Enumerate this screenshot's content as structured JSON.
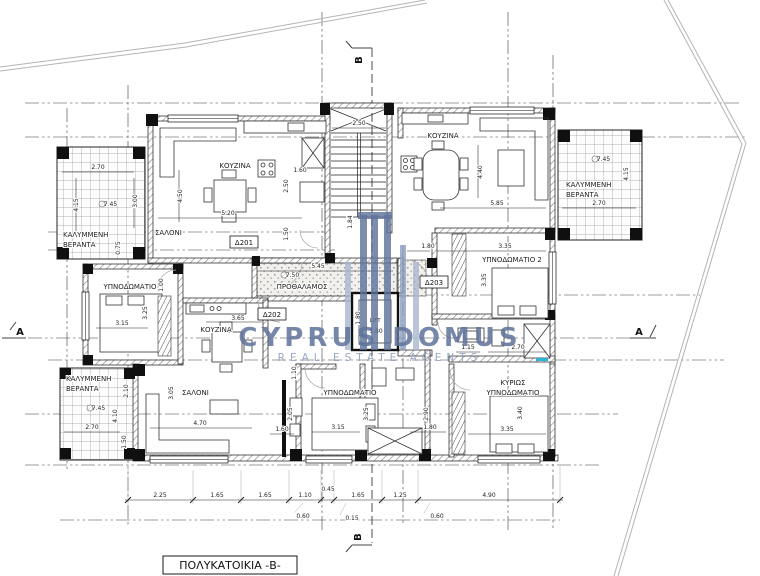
{
  "title": {
    "label": "ΠΟΛΥΚΑΤΟΙΚΙΑ -Β-"
  },
  "watermark": {
    "name": "CYPRUS DOMUS",
    "tagline": "REAL ESTATE AGENTS"
  },
  "colors": {
    "watermark_dark": "#5f739b",
    "watermark_light": "#a9b7cf",
    "accent_cyan": "#2ab5d8"
  },
  "sections": {
    "a": "A",
    "b": "B"
  },
  "units": {
    "d201": "Δ201",
    "d202": "Δ202",
    "d203": "Δ203"
  },
  "rooms": {
    "kitchen": "ΚΟΥΖΙΝΑ",
    "living": "ΣΑΛΟΝΙ",
    "bedroom": "ΥΠΝΟΔΩΜΑΤΙΟ",
    "bedroom2": "ΥΠΝΟΔΩΜΑΤΙΟ 2",
    "master_line1": "ΚΥΡΙΩΣ",
    "master_line2": "ΥΠΝΟΔΩΜΑΤΙΟ",
    "veranda_line1": "ΚΑΛΥΜΜΕΝΗ",
    "veranda_line2": "ΒΕΡΑΝΤΑ",
    "hall": "ΠΡΟΘΑΛΑΜΟΣ",
    "lift": "LIFT"
  },
  "levels": {
    "v745": "+7.45",
    "v750": "+7.50"
  },
  "dims": {
    "v015": "0.15",
    "v045": "0.45",
    "v060": "0.60",
    "v075": "0.75",
    "v100": "1.00",
    "v110": "1.10",
    "v115": "1.15",
    "v125": "1.25",
    "v150": "1.50",
    "v160": "1.60",
    "v165": "1.65",
    "v180": "1.80",
    "v184": "1.84",
    "v205": "2.05",
    "v210": "2.10",
    "v225": "2.25",
    "v250": "2.50",
    "v270": "2.70",
    "v290": "2.90",
    "v300": "3.00",
    "v305": "3.05",
    "v315": "3.15",
    "v325": "3.25",
    "v335": "3.35",
    "v340": "3.40",
    "v365": "3.65",
    "v410": "4.10",
    "v415": "4.15",
    "v440": "4.40",
    "v450": "4.50",
    "v470": "4.70",
    "v490": "4.90",
    "v520": "5.20",
    "v545": "5.45",
    "v585": "5.85"
  }
}
